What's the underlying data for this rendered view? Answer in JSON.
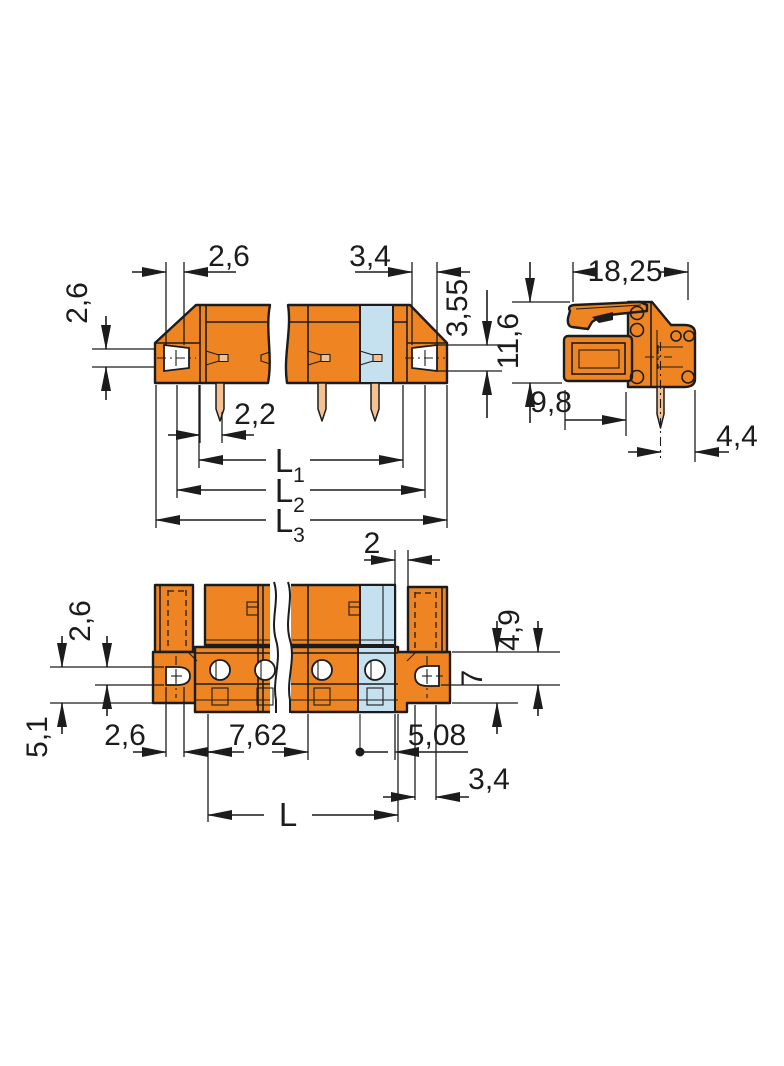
{
  "colors": {
    "body": "#EF8522",
    "pole": "#C5E1EF",
    "pin": "#F5C191",
    "line": "#1C1C1C",
    "bg": "#FFFFFF"
  },
  "side_view": {
    "hole_width": "2,6",
    "plug_hole_width": "3,4",
    "hole_height": "2,6",
    "plug_hole_height": "3,55",
    "pin_offset": "2,2",
    "length1": "L",
    "length1_sub": "1",
    "length2": "L",
    "length2_sub": "2",
    "length3": "L",
    "length3_sub": "3"
  },
  "end_view": {
    "overall_width": "18,25",
    "overall_height": "11,6",
    "pin_distance": "9,8",
    "pin_to_edge": "4,4"
  },
  "plan_view": {
    "end_gap": "2",
    "flange_hole_height": "2,6",
    "flange_left_height": "5,1",
    "flange_hole_width": "2,6",
    "pole_pitch": "7,62",
    "last_pole_to_edge": "5,08",
    "pin_channel_width": "3,4",
    "overall_length": "L",
    "hole_offset": "4,9",
    "flange_width": "7"
  }
}
